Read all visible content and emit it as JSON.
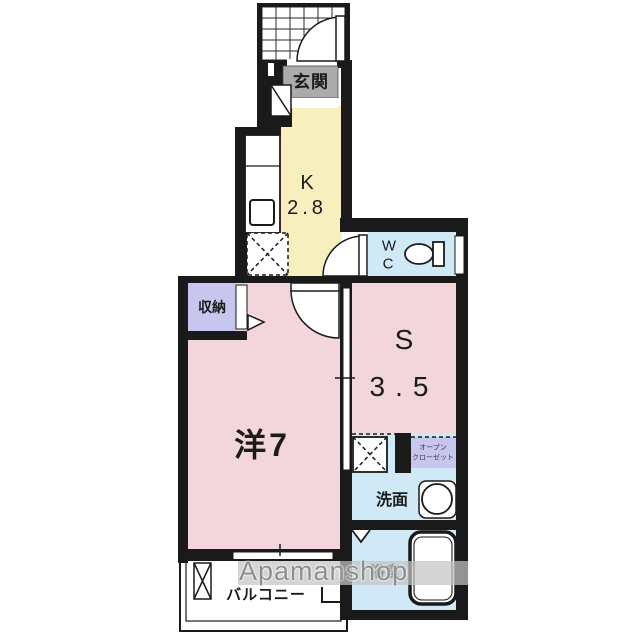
{
  "colors": {
    "wall": "#1a1a1a",
    "room_pink": "#f3d6db",
    "kitchen_yellow": "#f8efbe",
    "water_blue": "#cfe9f6",
    "closet_lavender": "#c6c6ee",
    "genkan_gray": "#ababab",
    "watermark_gray": "#8e8e8e"
  },
  "labels": {
    "genkan": "玄関",
    "kitchen_type": "K",
    "kitchen_size": "2.8",
    "wc_line1": "W",
    "wc_line2": "C",
    "storage": "収納",
    "western_room": "洋7",
    "service_type": "S",
    "service_size": "3.5",
    "open_closet_line1": "オープン",
    "open_closet_line2": "クローゼット",
    "washroom": "洗面",
    "bathroom": "浴室",
    "balcony": "バルコニー"
  },
  "watermark": {
    "text": "Apamanshop"
  }
}
